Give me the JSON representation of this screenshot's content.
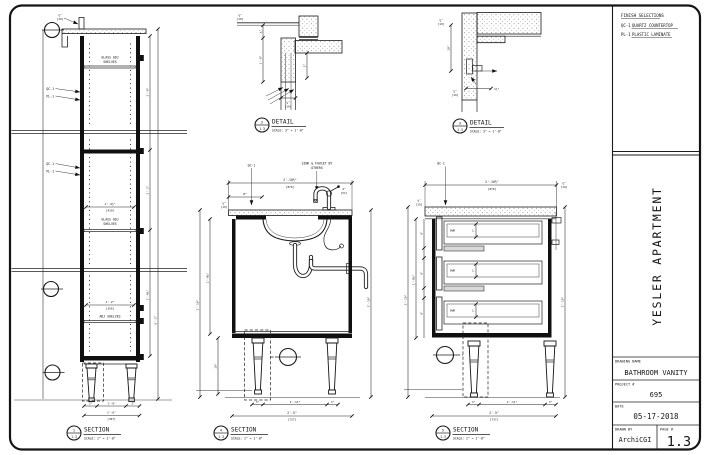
{
  "titleblock": {
    "finish": {
      "heading": "FINISH SELECTIONS",
      "items": [
        {
          "code": "QC-1",
          "label": "QUARTZ COUNTERTOP"
        },
        {
          "code": "PL-1",
          "label": "PLASTIC LAMINATE"
        }
      ]
    },
    "project_title": "YESLER APARTMENT",
    "drawing_name_label": "DRAWING NAME",
    "drawing_name": "BATHROOM VANITY",
    "project_label": "PROJECT #",
    "project_number": "695",
    "date_label": "DATE",
    "date": "05-17-2018",
    "drawn_by_label": "DRAWN BY",
    "drawn_by": "ArchiCGI",
    "page_label": "PAGE #",
    "page_number": "1.3"
  },
  "views": {
    "v1": {
      "num": "1",
      "sheet": "1.3",
      "name": "SECTION",
      "scale": "SCALE: 1\" = 1'-0\""
    },
    "v2": {
      "num": "2",
      "sheet": "1.3",
      "name": "DETAIL",
      "scale": "SCALE: 3\" = 1'-0\""
    },
    "v3": {
      "num": "3",
      "sheet": "1.3",
      "name": "DETAIL",
      "scale": "SCALE: 3\" = 1'-0\""
    },
    "v4": {
      "num": "4",
      "sheet": "1.3",
      "name": "SECTION",
      "scale": "SCALE: 1\" = 1'-0\""
    },
    "v5": {
      "num": "5",
      "sheet": "1.3",
      "name": "SECTION",
      "scale": "SCALE: 1\" = 1'-0\""
    }
  },
  "notes": {
    "qc1": "QC-1",
    "pl1": "PL-1",
    "sink_note_1": "SINK & FAUCET BY",
    "sink_note_2": "OTHERS",
    "glass_shelves_1": "GLASS ADJ",
    "glass_shelves_2": "SHELVES",
    "adj_shelves": "ADJ SHELVES",
    "dwr": "DWR"
  },
  "dims": {
    "w_top": "2'-10½\"",
    "w_top_mm": "[876]",
    "w_bot": "2'-5\"",
    "w_bot_mm": "[737]",
    "w_in": "1'-11\"",
    "w_in_mm": "[584]",
    "leg_w": "3\"",
    "leg_h": "10\"",
    "h_side": "1'-9¾\"",
    "h_all": "2'-10\"",
    "t34": "¾\"",
    "t34_mm": "[19]",
    "t2": "2\"",
    "t2_mm": "[51]",
    "fo": "8\"",
    "dh": "8\"",
    "di": "7\"",
    "s_w": "1'-6\"",
    "s_w_mm": "[457]",
    "s_in": "1'-4½\"",
    "s_in_mm": "[419]",
    "s_in2": "1'-2\"",
    "s_in2_mm": "[356]",
    "s_clear": "1'-0\"",
    "s_h1": "2'-0\"",
    "s_h2": "2'-2\"",
    "s_all": "6'-2\"",
    "d2a": "1'-0\"",
    "d2b": "2\"",
    "d2c": "¾\"",
    "d3a": "10\"",
    "d3b": "1½\""
  }
}
